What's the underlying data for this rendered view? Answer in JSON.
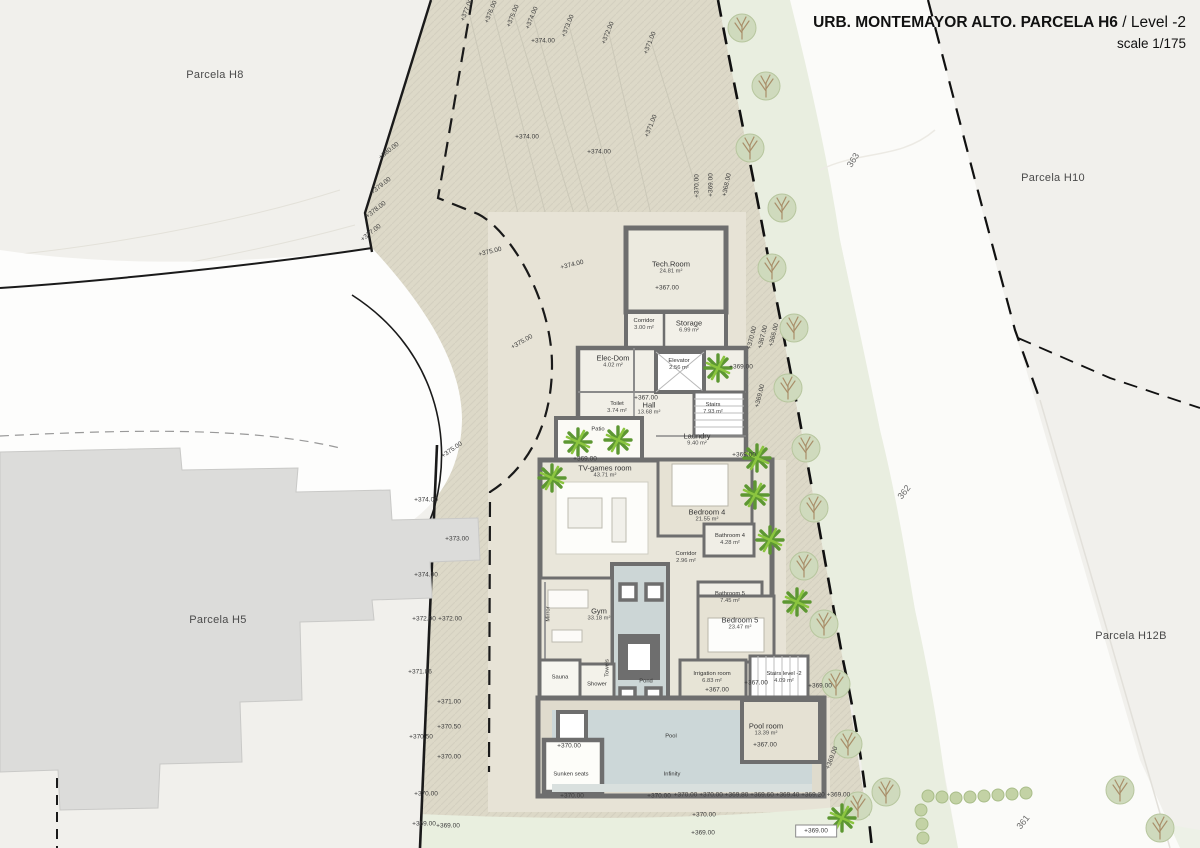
{
  "title": {
    "main": "URB. MONTEMAYOR ALTO. PARCELA H6",
    "suffix": " / Level -2",
    "scale": "scale 1/175"
  },
  "parcel_labels": [
    {
      "text": "Parcela H8",
      "x": 215,
      "y": 75
    },
    {
      "text": "Parcela H10",
      "x": 1053,
      "y": 178
    },
    {
      "text": "Parcela H5",
      "x": 218,
      "y": 620
    },
    {
      "text": "Parcela H12B",
      "x": 1131,
      "y": 636
    }
  ],
  "road_labels": [
    {
      "text": "363",
      "x": 853,
      "y": 160,
      "rot": -58
    },
    {
      "text": "362",
      "x": 904,
      "y": 492,
      "rot": -52
    },
    {
      "text": "361",
      "x": 1023,
      "y": 822,
      "rot": -52
    }
  ],
  "rooms": [
    {
      "name": "Tech.Room",
      "area": "24.81 m²",
      "x": 671,
      "y": 268
    },
    {
      "name": "Corridor",
      "area": "3.00 m²",
      "x": 644,
      "y": 325,
      "small": true
    },
    {
      "name": "Storage",
      "area": "6.99 m²",
      "x": 689,
      "y": 327
    },
    {
      "name": "Elec-Dom",
      "area": "4.02 m²",
      "x": 613,
      "y": 362
    },
    {
      "name": "Elevator",
      "area": "2.56 m²",
      "x": 679,
      "y": 365,
      "small": true
    },
    {
      "name": "Toilet",
      "area": "3.74 m²",
      "x": 617,
      "y": 408,
      "small": true
    },
    {
      "name": "Hall",
      "area": "13.68 m²",
      "x": 649,
      "y": 409
    },
    {
      "name": "Stairs",
      "area": "7.93 m²",
      "x": 713,
      "y": 409,
      "small": true
    },
    {
      "name": "Laundry",
      "area": "9.40 m²",
      "x": 697,
      "y": 440
    },
    {
      "name": "TV-games room",
      "area": "43.71 m²",
      "x": 605,
      "y": 472
    },
    {
      "name": "Bedroom 4",
      "area": "21.55 m²",
      "x": 707,
      "y": 516
    },
    {
      "name": "Bathroom 4",
      "area": "4.28 m²",
      "x": 730,
      "y": 540,
      "small": true
    },
    {
      "name": "Corridor",
      "area": "2.96 m²",
      "x": 686,
      "y": 558,
      "small": true
    },
    {
      "name": "Bathroom 5",
      "area": "7.45 m²",
      "x": 730,
      "y": 598,
      "small": true
    },
    {
      "name": "Gym",
      "area": "33.18 m²",
      "x": 599,
      "y": 615
    },
    {
      "name": "Bedroom 5",
      "area": "23.47 m²",
      "x": 740,
      "y": 624
    },
    {
      "name": "Sauna",
      "x": 560,
      "y": 678,
      "small": true
    },
    {
      "name": "Shower",
      "x": 597,
      "y": 685,
      "small": true
    },
    {
      "name": "Irrigation room",
      "area": "6.83 m²",
      "x": 712,
      "y": 678,
      "small": true
    },
    {
      "name": "Stairs level -2",
      "area": "4.09 m²",
      "x": 784,
      "y": 678,
      "small": true
    },
    {
      "name": "Pool room",
      "area": "13.39 m²",
      "x": 766,
      "y": 730
    },
    {
      "name": "Pool",
      "x": 671,
      "y": 737,
      "small": true
    },
    {
      "name": "Sunken seats",
      "x": 571,
      "y": 775,
      "small": true
    },
    {
      "name": "Infinity",
      "x": 672,
      "y": 775,
      "small": true
    },
    {
      "name": "Pond",
      "x": 646,
      "y": 682,
      "small": true
    },
    {
      "name": "Mirror",
      "x": 549,
      "y": 614,
      "rot": -90,
      "small": true
    },
    {
      "name": "Towels",
      "x": 608,
      "y": 668,
      "rot": -90,
      "small": true
    },
    {
      "name": "Patio",
      "x": 598,
      "y": 430,
      "small": true
    }
  ],
  "elevation_labels": [
    {
      "text": "+377.00",
      "x": 467,
      "y": 10,
      "rot": -68
    },
    {
      "text": "+376.00",
      "x": 491,
      "y": 12,
      "rot": -68
    },
    {
      "text": "+375.00",
      "x": 513,
      "y": 16,
      "rot": -68
    },
    {
      "text": "+374.00",
      "x": 532,
      "y": 18,
      "rot": -68
    },
    {
      "text": "+373.00",
      "x": 568,
      "y": 26,
      "rot": -68
    },
    {
      "text": "+372.00",
      "x": 608,
      "y": 33,
      "rot": -68
    },
    {
      "text": "+371.00",
      "x": 650,
      "y": 43,
      "rot": -68
    },
    {
      "text": "+374.00",
      "x": 543,
      "y": 41,
      "rot": 0
    },
    {
      "text": "+374.00",
      "x": 527,
      "y": 137,
      "rot": 0
    },
    {
      "text": "+371.00",
      "x": 651,
      "y": 126,
      "rot": -68
    },
    {
      "text": "+374.00",
      "x": 599,
      "y": 152,
      "rot": 0
    },
    {
      "text": "+380.00",
      "x": 389,
      "y": 151,
      "rot": -38
    },
    {
      "text": "+379.00",
      "x": 381,
      "y": 186,
      "rot": -38
    },
    {
      "text": "+378.00",
      "x": 376,
      "y": 210,
      "rot": -38
    },
    {
      "text": "+377.00",
      "x": 371,
      "y": 233,
      "rot": -38
    },
    {
      "text": "+375.00",
      "x": 490,
      "y": 252,
      "rot": -14
    },
    {
      "text": "+374.00",
      "x": 572,
      "y": 265,
      "rot": -14
    },
    {
      "text": "+375.00",
      "x": 522,
      "y": 342,
      "rot": -30
    },
    {
      "text": "+375.00",
      "x": 452,
      "y": 450,
      "rot": -35
    },
    {
      "text": "+374.00",
      "x": 426,
      "y": 500,
      "rot": 0
    },
    {
      "text": "+373.00",
      "x": 457,
      "y": 539,
      "rot": 0
    },
    {
      "text": "+374.00",
      "x": 426,
      "y": 575,
      "rot": 0
    },
    {
      "text": "+372.90",
      "x": 424,
      "y": 619,
      "rot": 0
    },
    {
      "text": "+372.00",
      "x": 450,
      "y": 619,
      "rot": 0
    },
    {
      "text": "+371.86",
      "x": 420,
      "y": 672,
      "rot": 0
    },
    {
      "text": "+371.00",
      "x": 449,
      "y": 702,
      "rot": 0
    },
    {
      "text": "+370.50",
      "x": 449,
      "y": 727,
      "rot": 0
    },
    {
      "text": "+370.50",
      "x": 421,
      "y": 737,
      "rot": 0
    },
    {
      "text": "+370.00",
      "x": 449,
      "y": 757,
      "rot": 0
    },
    {
      "text": "+370.00",
      "x": 426,
      "y": 794,
      "rot": 0
    },
    {
      "text": "+369.00",
      "x": 424,
      "y": 824,
      "rot": 0
    },
    {
      "text": "+369.00",
      "x": 448,
      "y": 826,
      "rot": 0
    },
    {
      "text": "+370.00",
      "x": 697,
      "y": 186,
      "rot": -90
    },
    {
      "text": "+369.00",
      "x": 711,
      "y": 185,
      "rot": -90
    },
    {
      "text": "+368.00",
      "x": 727,
      "y": 185,
      "rot": -78
    },
    {
      "text": "+370.00",
      "x": 752,
      "y": 338,
      "rot": -76
    },
    {
      "text": "+367.00",
      "x": 763,
      "y": 337,
      "rot": -76
    },
    {
      "text": "+366.00",
      "x": 774,
      "y": 335,
      "rot": -76
    },
    {
      "text": "+369.00",
      "x": 760,
      "y": 396,
      "rot": -76
    },
    {
      "text": "+369.00",
      "x": 741,
      "y": 367,
      "rot": 0
    },
    {
      "text": "+367.00",
      "x": 667,
      "y": 288,
      "rot": 0
    },
    {
      "text": "+367.00",
      "x": 646,
      "y": 398,
      "rot": 0
    },
    {
      "text": "+369.00",
      "x": 585,
      "y": 459,
      "rot": 0
    },
    {
      "text": "+369.00",
      "x": 744,
      "y": 455,
      "rot": 0
    },
    {
      "text": "+367.00",
      "x": 717,
      "y": 690,
      "rot": 0
    },
    {
      "text": "+367.00",
      "x": 756,
      "y": 683,
      "rot": 0
    },
    {
      "text": "+369.00",
      "x": 820,
      "y": 686,
      "rot": 0
    },
    {
      "text": "+370.00",
      "x": 569,
      "y": 746,
      "rot": 0
    },
    {
      "text": "+367.00",
      "x": 765,
      "y": 745,
      "rot": 0
    },
    {
      "text": "+369.00",
      "x": 832,
      "y": 758,
      "rot": -70
    },
    {
      "text": "+370.00",
      "x": 572,
      "y": 796,
      "rot": 0
    },
    {
      "text": "+370.00",
      "x": 659,
      "y": 796,
      "rot": 0
    },
    {
      "text": "+370.00 +370.00 +369.80 +369.60 +369.40 +369.20 +369.00",
      "x": 762,
      "y": 795,
      "rot": 0
    },
    {
      "text": "+370.00",
      "x": 704,
      "y": 815,
      "rot": 0
    },
    {
      "text": "+369.00",
      "x": 703,
      "y": 833,
      "rot": 0
    },
    {
      "text": "+369.00",
      "x": 816,
      "y": 831,
      "rot": 0,
      "box": true
    }
  ],
  "colors": {
    "parcel_fill": "#ddd9c8",
    "terrace_fill": "#e7e3d6",
    "wall": "#6e6e6e",
    "water": "#ccd7d8",
    "green_belt": "#e9eee0",
    "belt_tree": "#cfdabd",
    "palm_green": "#6fae35",
    "background": "#f1f0ec",
    "road_white": "#fbfbf9",
    "h5_building": "#dcdcda"
  }
}
